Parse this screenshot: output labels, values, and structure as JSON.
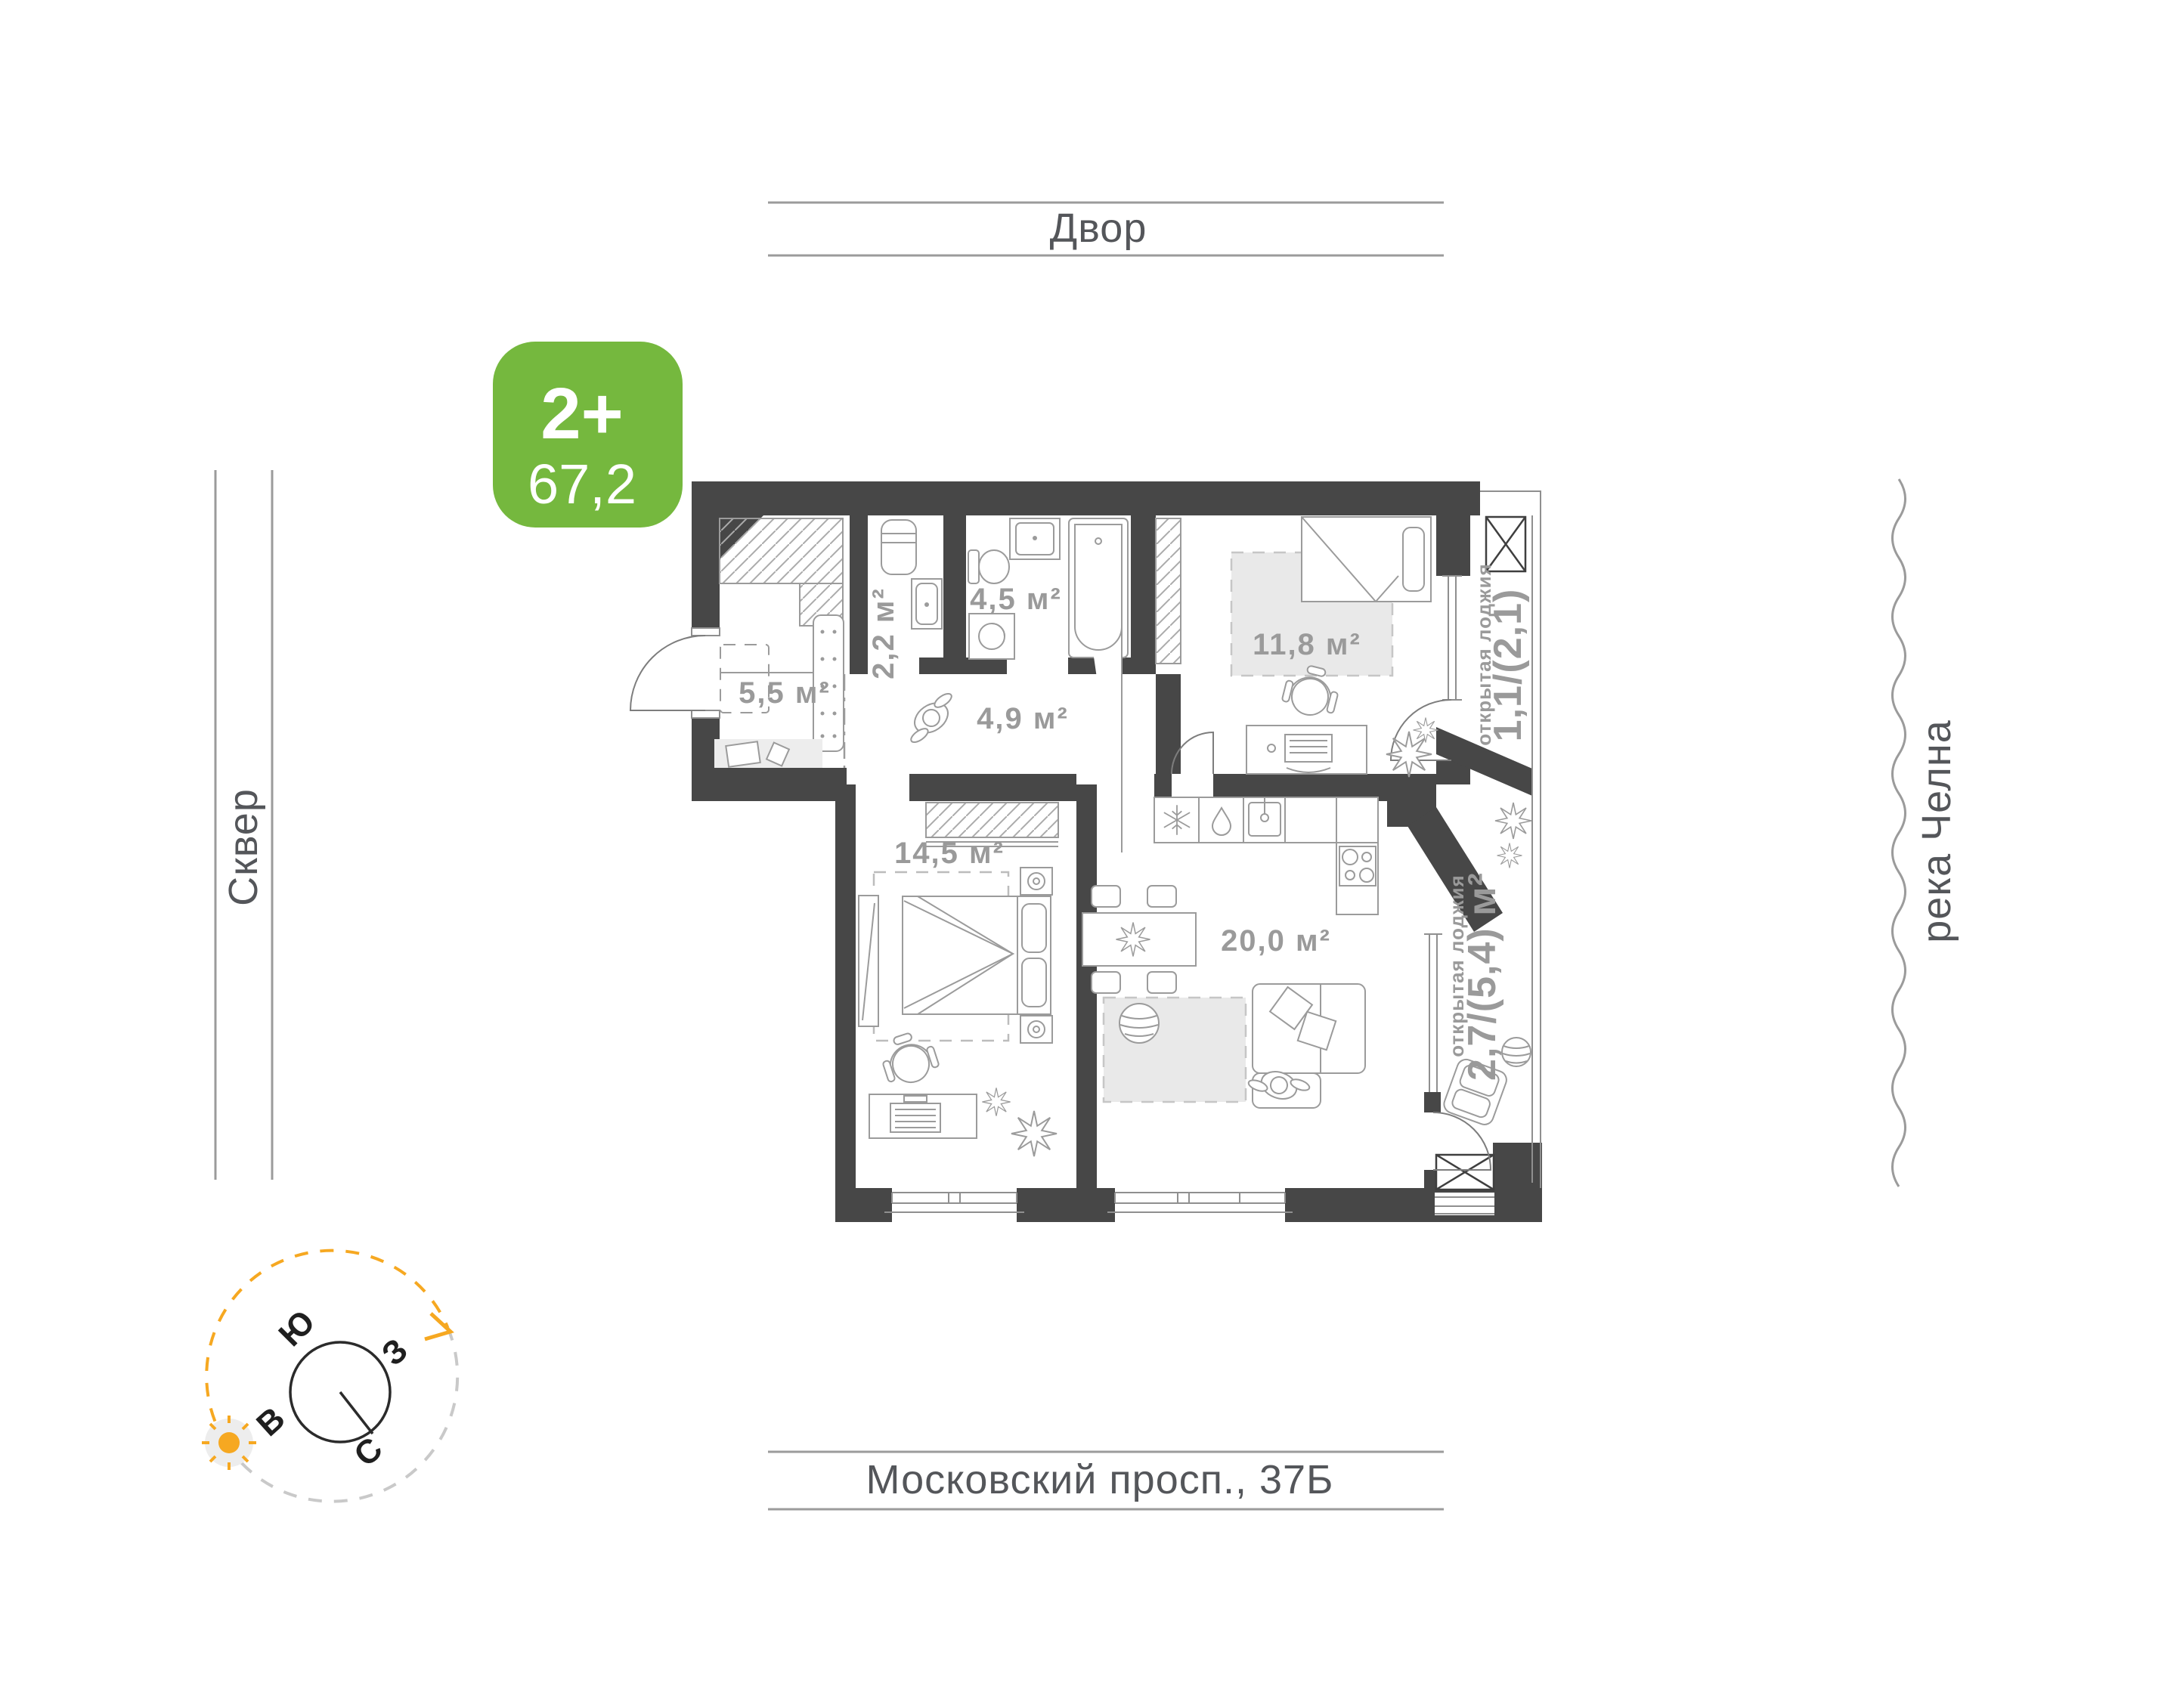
{
  "badge": {
    "type_label": "2+",
    "area_value": "67,2"
  },
  "surroundings": {
    "top_label": "Двор",
    "left_label": "Сквер",
    "right_label": "река Челна",
    "bottom_label": "Московский просп., 37Б"
  },
  "plan": {
    "room_labels": {
      "hallway": "5,5 м²",
      "dressing": "2,2 м²",
      "bathroom": "4,5 м²",
      "corridor": "4,9 м²",
      "bedroom_small": "11,8 м²",
      "bedroom_master": "14,5 м²",
      "kitchen_living": "20,0 м²"
    },
    "loggia_top": {
      "type_label": "открытая лоджия",
      "area_label": "1,1/(2,1)"
    },
    "loggia_bottom": {
      "type_label": "открытая лоджия",
      "area_label": "2,7/(5,4) м²"
    }
  },
  "compass": {
    "south_label": "Ю",
    "west_label": "З",
    "east_label": "В",
    "north_label": "С"
  },
  "colors": {
    "badge_green": "#75b83e",
    "accent_orange": "#f6a821",
    "wall_dark": "#474747",
    "label_gray": "#9a9a9a"
  }
}
